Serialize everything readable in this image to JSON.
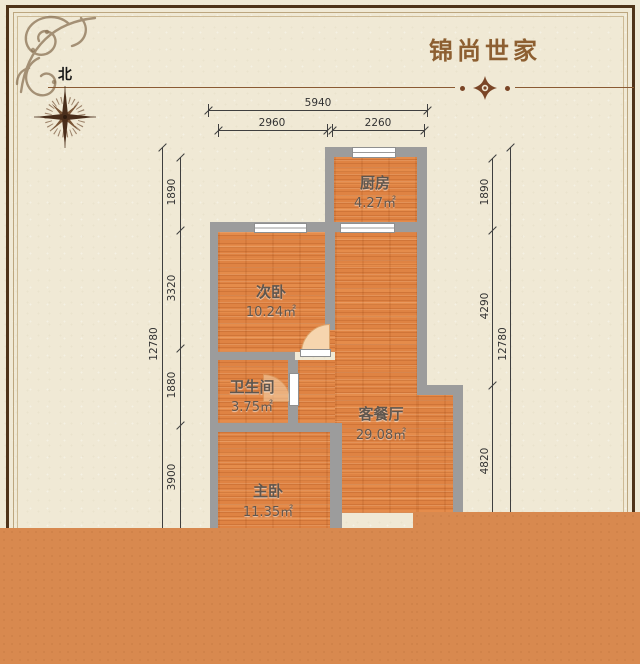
{
  "header": {
    "title": "锦尚世家"
  },
  "compass": {
    "north_label": "北"
  },
  "floorplan": {
    "rooms": [
      {
        "name": "厨房",
        "area": "4.27㎡"
      },
      {
        "name": "次卧",
        "area": "10.24㎡"
      },
      {
        "name": "卫生间",
        "area": "3.75㎡"
      },
      {
        "name": "客餐厅",
        "area": "29.08㎡"
      },
      {
        "name": "主卧",
        "area": "11.35㎡"
      }
    ],
    "dimensions": {
      "top": {
        "total": "5940",
        "segments": [
          "2960",
          "2260"
        ]
      },
      "left": {
        "total": "12780",
        "segments": [
          "1890",
          "3320",
          "1880",
          "3900"
        ]
      },
      "right": {
        "total": "12780",
        "segments": [
          "1890",
          "4290",
          "4820"
        ]
      }
    }
  },
  "colors": {
    "accent_brown": "#8D5F31",
    "wall_gray": "#9C9C9C",
    "floor_orange": "#DF8343",
    "band_orange": "#D8894F",
    "background": "#F0E9D5"
  }
}
